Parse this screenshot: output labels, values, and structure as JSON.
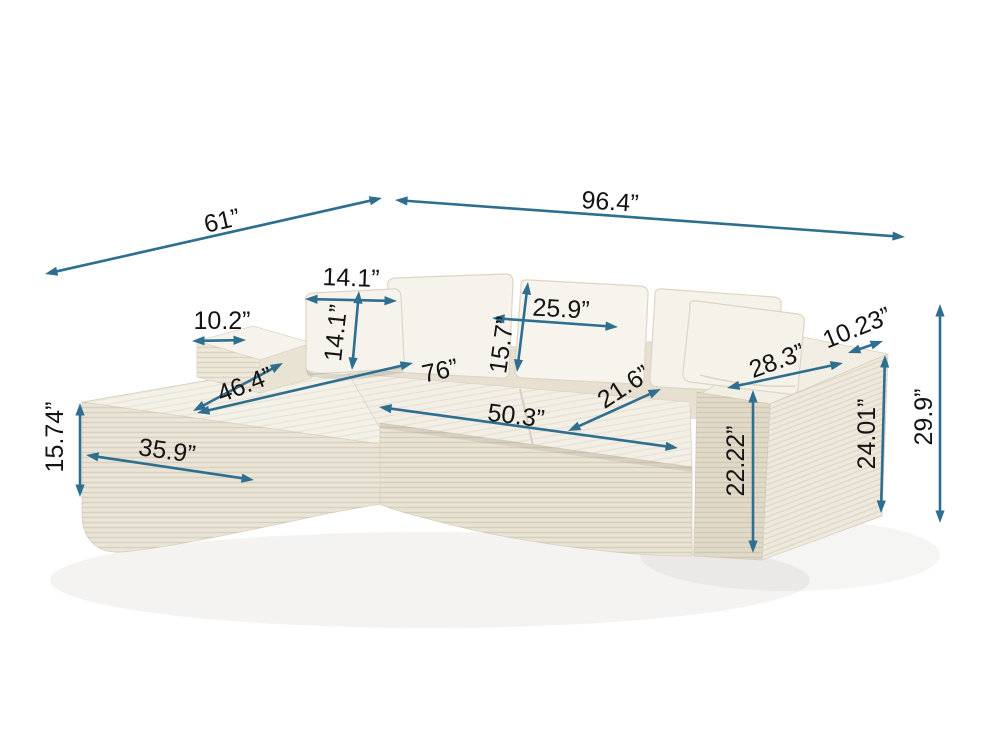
{
  "product": {
    "type": "sectional-sofa-with-left-chaise",
    "fabric": "corduroy",
    "color_name": "ivory"
  },
  "unit": "inches",
  "colors": {
    "background": "#ffffff",
    "arrow": "#2e6e8f",
    "label": "#141414",
    "fabric_light": "#f5f2ea",
    "fabric_mid": "#ece6d9",
    "fabric_dark": "#ded6c5"
  },
  "dimensions": [
    {
      "id": "depth-left-overall",
      "label": "61”",
      "inches": 61,
      "arrow": {
        "x1": 45,
        "y1": 274,
        "x2": 382,
        "y2": 198
      },
      "text": {
        "x": 222,
        "y": 221,
        "rot": -13
      }
    },
    {
      "id": "width-overall",
      "label": "96.4”",
      "inches": 96.4,
      "arrow": {
        "x1": 395,
        "y1": 200,
        "x2": 905,
        "y2": 237
      },
      "text": {
        "x": 610,
        "y": 202,
        "rot": 4
      }
    },
    {
      "id": "pillow-width",
      "label": "14.1”",
      "inches": 14.1,
      "arrow": {
        "x1": 305,
        "y1": 299,
        "x2": 397,
        "y2": 301
      },
      "text": {
        "x": 351,
        "y": 278,
        "rot": 2
      }
    },
    {
      "id": "pillow-height",
      "label": "14.1”",
      "inches": 14.1,
      "arrow": {
        "x1": 359,
        "y1": 291,
        "x2": 352,
        "y2": 370
      },
      "text": {
        "x": 336,
        "y": 333,
        "rot": -84
      }
    },
    {
      "id": "armrest-left-width",
      "label": "10.2”",
      "inches": 10.2,
      "arrow": {
        "x1": 192,
        "y1": 341,
        "x2": 246,
        "y2": 340
      },
      "text": {
        "x": 222,
        "y": 321,
        "rot": 0
      }
    },
    {
      "id": "back-cushion-width",
      "label": "25.9”",
      "inches": 25.9,
      "arrow": {
        "x1": 492,
        "y1": 318,
        "x2": 618,
        "y2": 327
      },
      "text": {
        "x": 561,
        "y": 309,
        "rot": 3
      }
    },
    {
      "id": "back-cushion-height",
      "label": "15.7”",
      "inches": 15.7,
      "arrow": {
        "x1": 528,
        "y1": 282,
        "x2": 517,
        "y2": 372
      },
      "text": {
        "x": 502,
        "y": 345,
        "rot": -82
      }
    },
    {
      "id": "chaise-length",
      "label": "46.4”",
      "inches": 46.4,
      "arrow": {
        "x1": 283,
        "y1": 363,
        "x2": 193,
        "y2": 411
      },
      "text": {
        "x": 245,
        "y": 385,
        "rot": -21
      }
    },
    {
      "id": "interior-width",
      "label": "76”",
      "inches": 76,
      "arrow": {
        "x1": 197,
        "y1": 413,
        "x2": 413,
        "y2": 363
      },
      "text": {
        "x": 440,
        "y": 371,
        "rot": -12
      }
    },
    {
      "id": "seat-width",
      "label": "50.3”",
      "inches": 50.3,
      "arrow": {
        "x1": 379,
        "y1": 407,
        "x2": 678,
        "y2": 448
      },
      "text": {
        "x": 516,
        "y": 416,
        "rot": 7
      }
    },
    {
      "id": "seat-depth",
      "label": "21.6”",
      "inches": 21.6,
      "arrow": {
        "x1": 568,
        "y1": 431,
        "x2": 661,
        "y2": 389
      },
      "text": {
        "x": 624,
        "y": 387,
        "rot": -33
      }
    },
    {
      "id": "armrest-depth",
      "label": "28.3”",
      "inches": 28.3,
      "arrow": {
        "x1": 727,
        "y1": 388,
        "x2": 843,
        "y2": 363
      },
      "text": {
        "x": 777,
        "y": 361,
        "rot": -20
      }
    },
    {
      "id": "armrest-width",
      "label": "10.23”",
      "inches": 10.23,
      "arrow": {
        "x1": 848,
        "y1": 353,
        "x2": 883,
        "y2": 341
      },
      "text": {
        "x": 857,
        "y": 328,
        "rot": -22
      }
    },
    {
      "id": "seat-front-height",
      "label": "22.22”",
      "inches": 22.22,
      "arrow": {
        "x1": 753,
        "y1": 390,
        "x2": 753,
        "y2": 553
      },
      "text": {
        "x": 736,
        "y": 461,
        "rot": -90
      }
    },
    {
      "id": "armrest-height",
      "label": "24.01”",
      "inches": 24.01,
      "arrow": {
        "x1": 885,
        "y1": 355,
        "x2": 881,
        "y2": 513
      },
      "text": {
        "x": 867,
        "y": 434,
        "rot": -90
      }
    },
    {
      "id": "overall-height",
      "label": "29.9”",
      "inches": 29.9,
      "arrow": {
        "x1": 940,
        "y1": 304,
        "x2": 940,
        "y2": 523
      },
      "text": {
        "x": 924,
        "y": 417,
        "rot": -90
      }
    },
    {
      "id": "chaise-height",
      "label": "15.74”",
      "inches": 15.74,
      "arrow": {
        "x1": 80,
        "y1": 403,
        "x2": 80,
        "y2": 497
      },
      "text": {
        "x": 55,
        "y": 437,
        "rot": -90
      }
    },
    {
      "id": "chaise-width",
      "label": "35.9”",
      "inches": 35.9,
      "arrow": {
        "x1": 86,
        "y1": 455,
        "x2": 254,
        "y2": 480
      },
      "text": {
        "x": 167,
        "y": 451,
        "rot": 8
      }
    }
  ]
}
